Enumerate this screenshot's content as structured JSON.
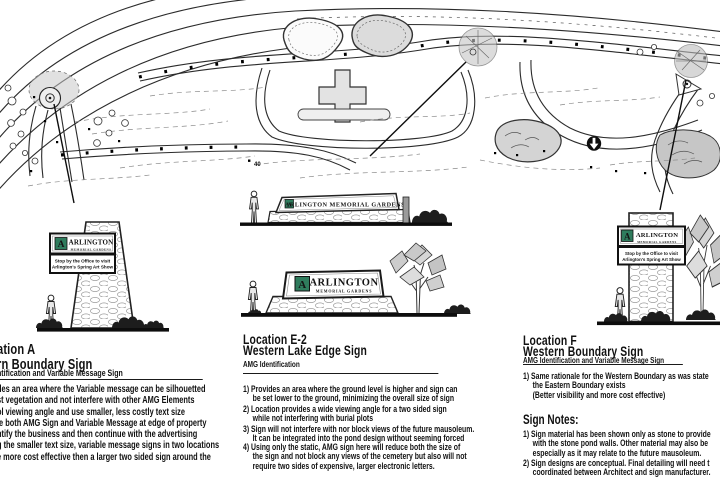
{
  "sheet": {
    "background": "#ffffff",
    "accent_green": "#2f7c5d"
  },
  "map": {
    "labels": {
      "plot_number": "40"
    }
  },
  "signs": {
    "location_a": {
      "logo_monogram": "A",
      "logo_line1": "ARLINGTON",
      "logo_line2": "MEMORIAL GARDENS",
      "message_line1": "Stop by the Office to visit",
      "message_line2": "Arlington's Spring Art Show"
    },
    "lake_upper": {
      "logo_monogram": "A",
      "logo_text": "ARLINGTON  MEMORIAL GARDENS"
    },
    "lake_lower": {
      "logo_monogram": "A",
      "logo_line1": "ARLINGTON",
      "logo_line2": "MEMORIAL GARDENS"
    },
    "location_f": {
      "logo_monogram": "A",
      "logo_line1": "ARLINGTON",
      "logo_line2": "MEMORIAL GARDENS",
      "message_line1": "Stop by the Office to visit",
      "message_line2": "Arlington's Spring Art Show"
    }
  },
  "columns": {
    "location_a": {
      "title_line1": "ation A",
      "title_line2": "rn Boundary Sign",
      "subtitle": "ntification and Variable Message Sign",
      "body_lines": [
        "des an area where the Variable message can be silhouetted",
        "st vegetation and not interfere with other AMG Elements",
        "ol viewing angle and use smaller, less costly text size",
        "le both AMG Sign and Variable Message at edge of property",
        "ntify the business and then continue with the advertising",
        "g the smaller text size, variable message signs in two locations",
        "e more cost effective then a larger two sided sign around the"
      ]
    },
    "location_e2": {
      "title_line1": "Location E-2",
      "title_line2": "Western Lake Edge Sign",
      "subtitle": "AMG Identification",
      "items": [
        {
          "lines": [
            "1)  Provides an area where the ground level is higher and sign can",
            "be set lower to the ground, minimizing the overall size of sign"
          ]
        },
        {
          "lines": [
            "2) Location provides a wide viewing angle for a two sided sign",
            "while not interfering with burial plots"
          ]
        },
        {
          "lines": [
            "3) Sign will not interfere with nor block views of the future mausoleum.",
            "It can be integrated into the pond design without seeming forced"
          ]
        },
        {
          "lines": [
            "4) Using only the static, AMG sign here will reduce both the size of",
            "the sign and not block any views of the cemetery but also will not",
            "require two sides of expensive, larger electronic letters."
          ]
        }
      ]
    },
    "location_f": {
      "title_line1": "Location F",
      "title_line2": "Western Boundary Sign",
      "subtitle": "AMG Identification and Variable Message Sign",
      "items": [
        {
          "lines": [
            "1)  Same rationale for the Western Boundary as was state",
            "the Eastern Boundary exists",
            "(Better visibility and more cost effective)"
          ]
        }
      ],
      "notes_heading": "Sign Notes:",
      "notes": [
        {
          "lines": [
            "1)  Sign material has been shown only as stone to provide",
            "with the stone pond walls. Other material may also be",
            "especially as it may relate to the future mausoleum."
          ]
        },
        {
          "lines": [
            "2) Sign designs are conceptual. Final detailing will need t",
            "coordinated between Architect and sign manufacturer."
          ]
        }
      ]
    }
  }
}
